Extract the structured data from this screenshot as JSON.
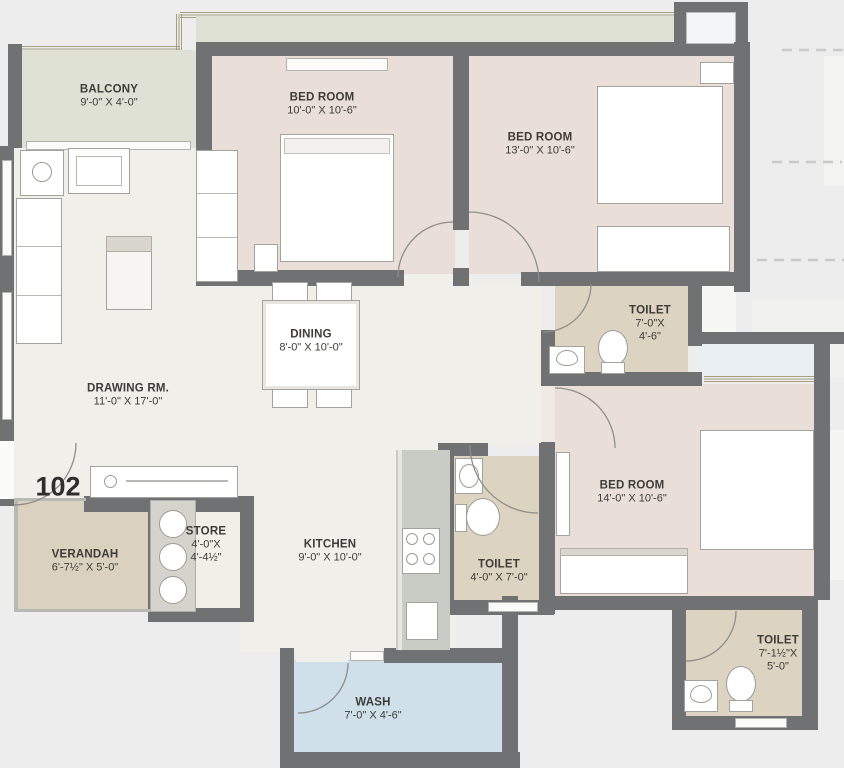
{
  "plan": {
    "unit_number": "102",
    "rooms": {
      "balcony": {
        "label": "BALCONY",
        "dims": "9'-0\" X 4'-0\""
      },
      "bedroom1": {
        "label": "BED ROOM",
        "dims": "10'-0\" X 10'-6\""
      },
      "bedroom2": {
        "label": "BED ROOM",
        "dims": "13'-0\" X 10'-6\""
      },
      "bedroom3": {
        "label": "BED ROOM",
        "dims": "14'-0\" X 10'-6\""
      },
      "toilet1": {
        "label": "TOILET",
        "dims_line1": "7'-0\"X",
        "dims_line2": "4'-6\""
      },
      "toilet2": {
        "label": "TOILET",
        "dims": "4'-0\" X 7'-0\""
      },
      "toilet3": {
        "label": "TOILET",
        "dims_line1": "7'-1½\"X",
        "dims_line2": "5'-0\""
      },
      "drawing_room": {
        "label": "DRAWING RM.",
        "dims": "11'-0\" X 17'-0\""
      },
      "dining": {
        "label": "DINING",
        "dims": "8'-0\" X 10'-0\""
      },
      "kitchen": {
        "label": "KITCHEN",
        "dims": "9'-0\" X 10'-0\""
      },
      "store": {
        "label": "STORE",
        "dims_line1": "4'-0\"X",
        "dims_line2": "4'-4½\""
      },
      "verandah": {
        "label": "VERANDAH",
        "dims": "6'-7½\" X 5'-0\""
      },
      "wash": {
        "label": "WASH",
        "dims": "7'-0\" X 4'-6\""
      }
    },
    "colors": {
      "wall": "#6f7173",
      "floor": "#f0efe9",
      "bedroom": "#e9dfd8",
      "toilet": "#ddd3c1",
      "balcony": "#dfe1d5",
      "verandah": "#dbd1bf",
      "wash": "#cfe0ea",
      "trim": "#a59f80",
      "text": "#3d3c39"
    }
  }
}
